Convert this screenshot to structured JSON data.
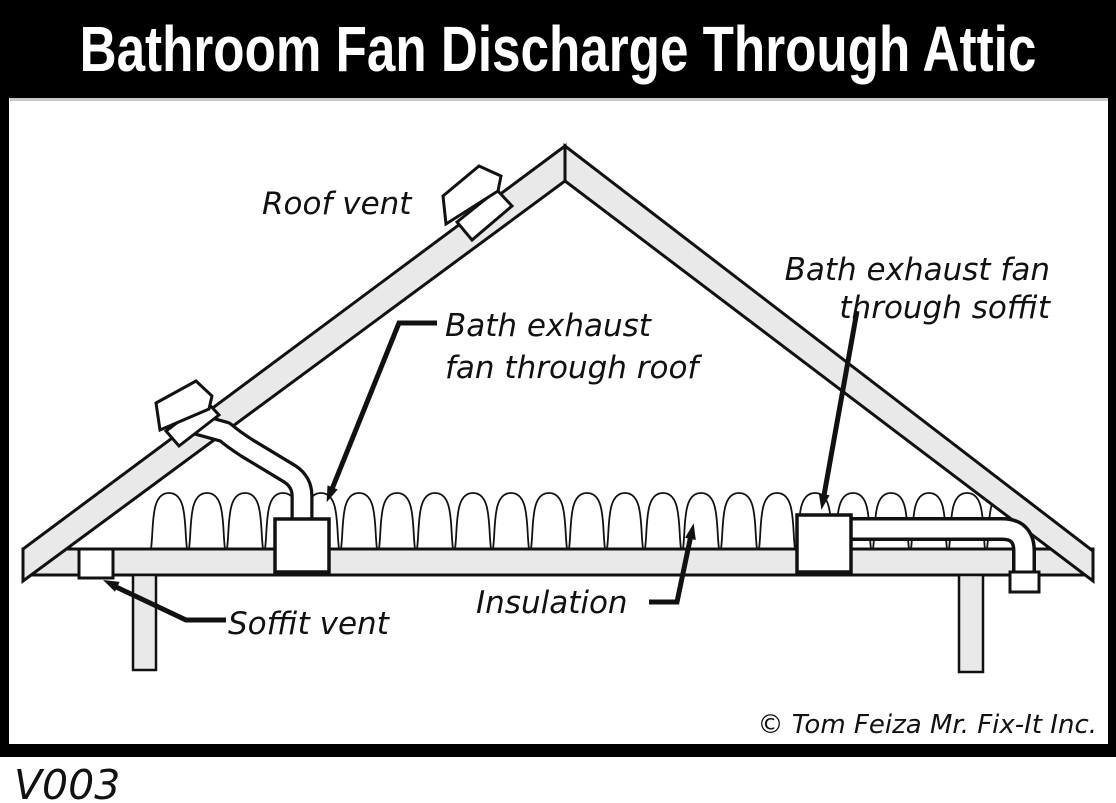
{
  "title": "Bathroom Fan Discharge Through Attic",
  "figure_code": "V003",
  "copyright": "© Tom Feiza Mr. Fix-It Inc.",
  "diagram": {
    "labels": {
      "roof_vent": "Roof vent",
      "bath_fan_roof": [
        "Bath exhaust",
        "fan through roof"
      ],
      "bath_fan_soffit": [
        "Bath exhaust fan",
        "through soffit"
      ],
      "insulation": "Insulation",
      "soffit_vent": "Soffit vent"
    },
    "colors": {
      "line": "#111111",
      "wood_fill": "#e9e9e9",
      "frame": "#000000",
      "title_bg": "#000000",
      "title_text": "#ffffff",
      "background": "#ffffff"
    }
  }
}
